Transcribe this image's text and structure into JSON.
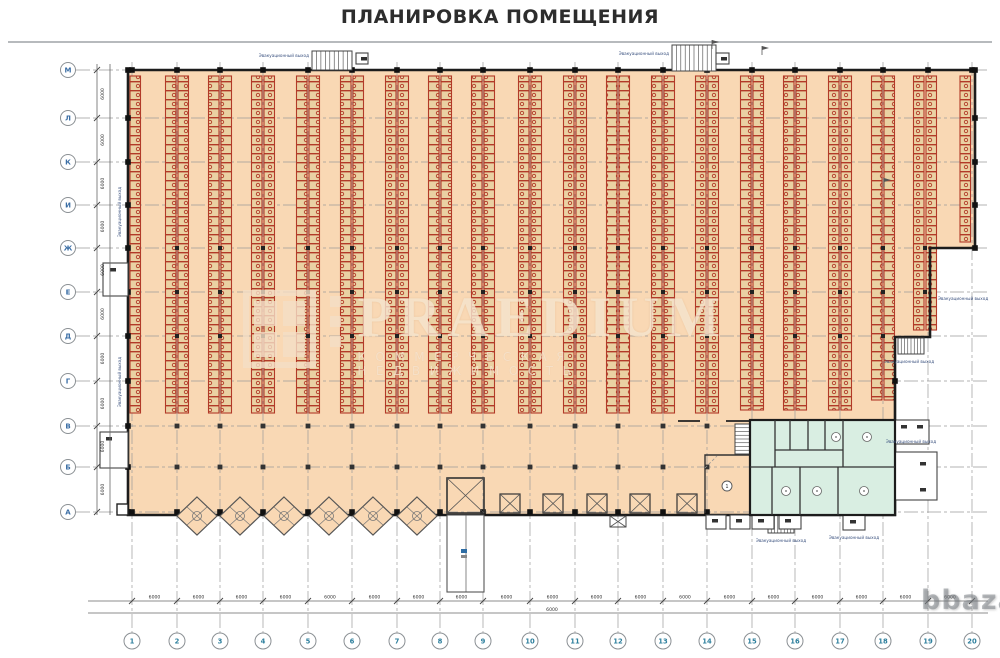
{
  "title": "ПЛАНИРОВКА ПОМЕЩЕНИЯ",
  "axes": {
    "rows": [
      "М",
      "Л",
      "К",
      "И",
      "Ж",
      "Е",
      "Д",
      "Г",
      "В",
      "Б",
      "А"
    ],
    "cols": [
      "1",
      "2",
      "3",
      "4",
      "5",
      "6",
      "7",
      "8",
      "9",
      "10",
      "11",
      "12",
      "13",
      "14",
      "15",
      "16",
      "17",
      "18",
      "19",
      "20"
    ]
  },
  "dimensions": {
    "bay_width": "6000",
    "bay_depth": "6000"
  },
  "labels": {
    "exit": "Эвакуационный выход",
    "room_number": "1"
  },
  "watermark": {
    "brand": "PRAEDIUM",
    "tagline": "КОММЕРЧЕСКАЯ НЕДВИЖИМОСТЬ",
    "site_logo": "bbaza"
  },
  "colors": {
    "warehouse_floor": "#f9d8b4",
    "rack_red": "#b23a28",
    "rack_cell": "#ead1a3",
    "office_green": "#d9eee2",
    "wall": "#1c1c1c",
    "grid": "#9a9a9a",
    "axis_letter": "#3b6ea5",
    "axis_number": "#2d7f9d"
  }
}
